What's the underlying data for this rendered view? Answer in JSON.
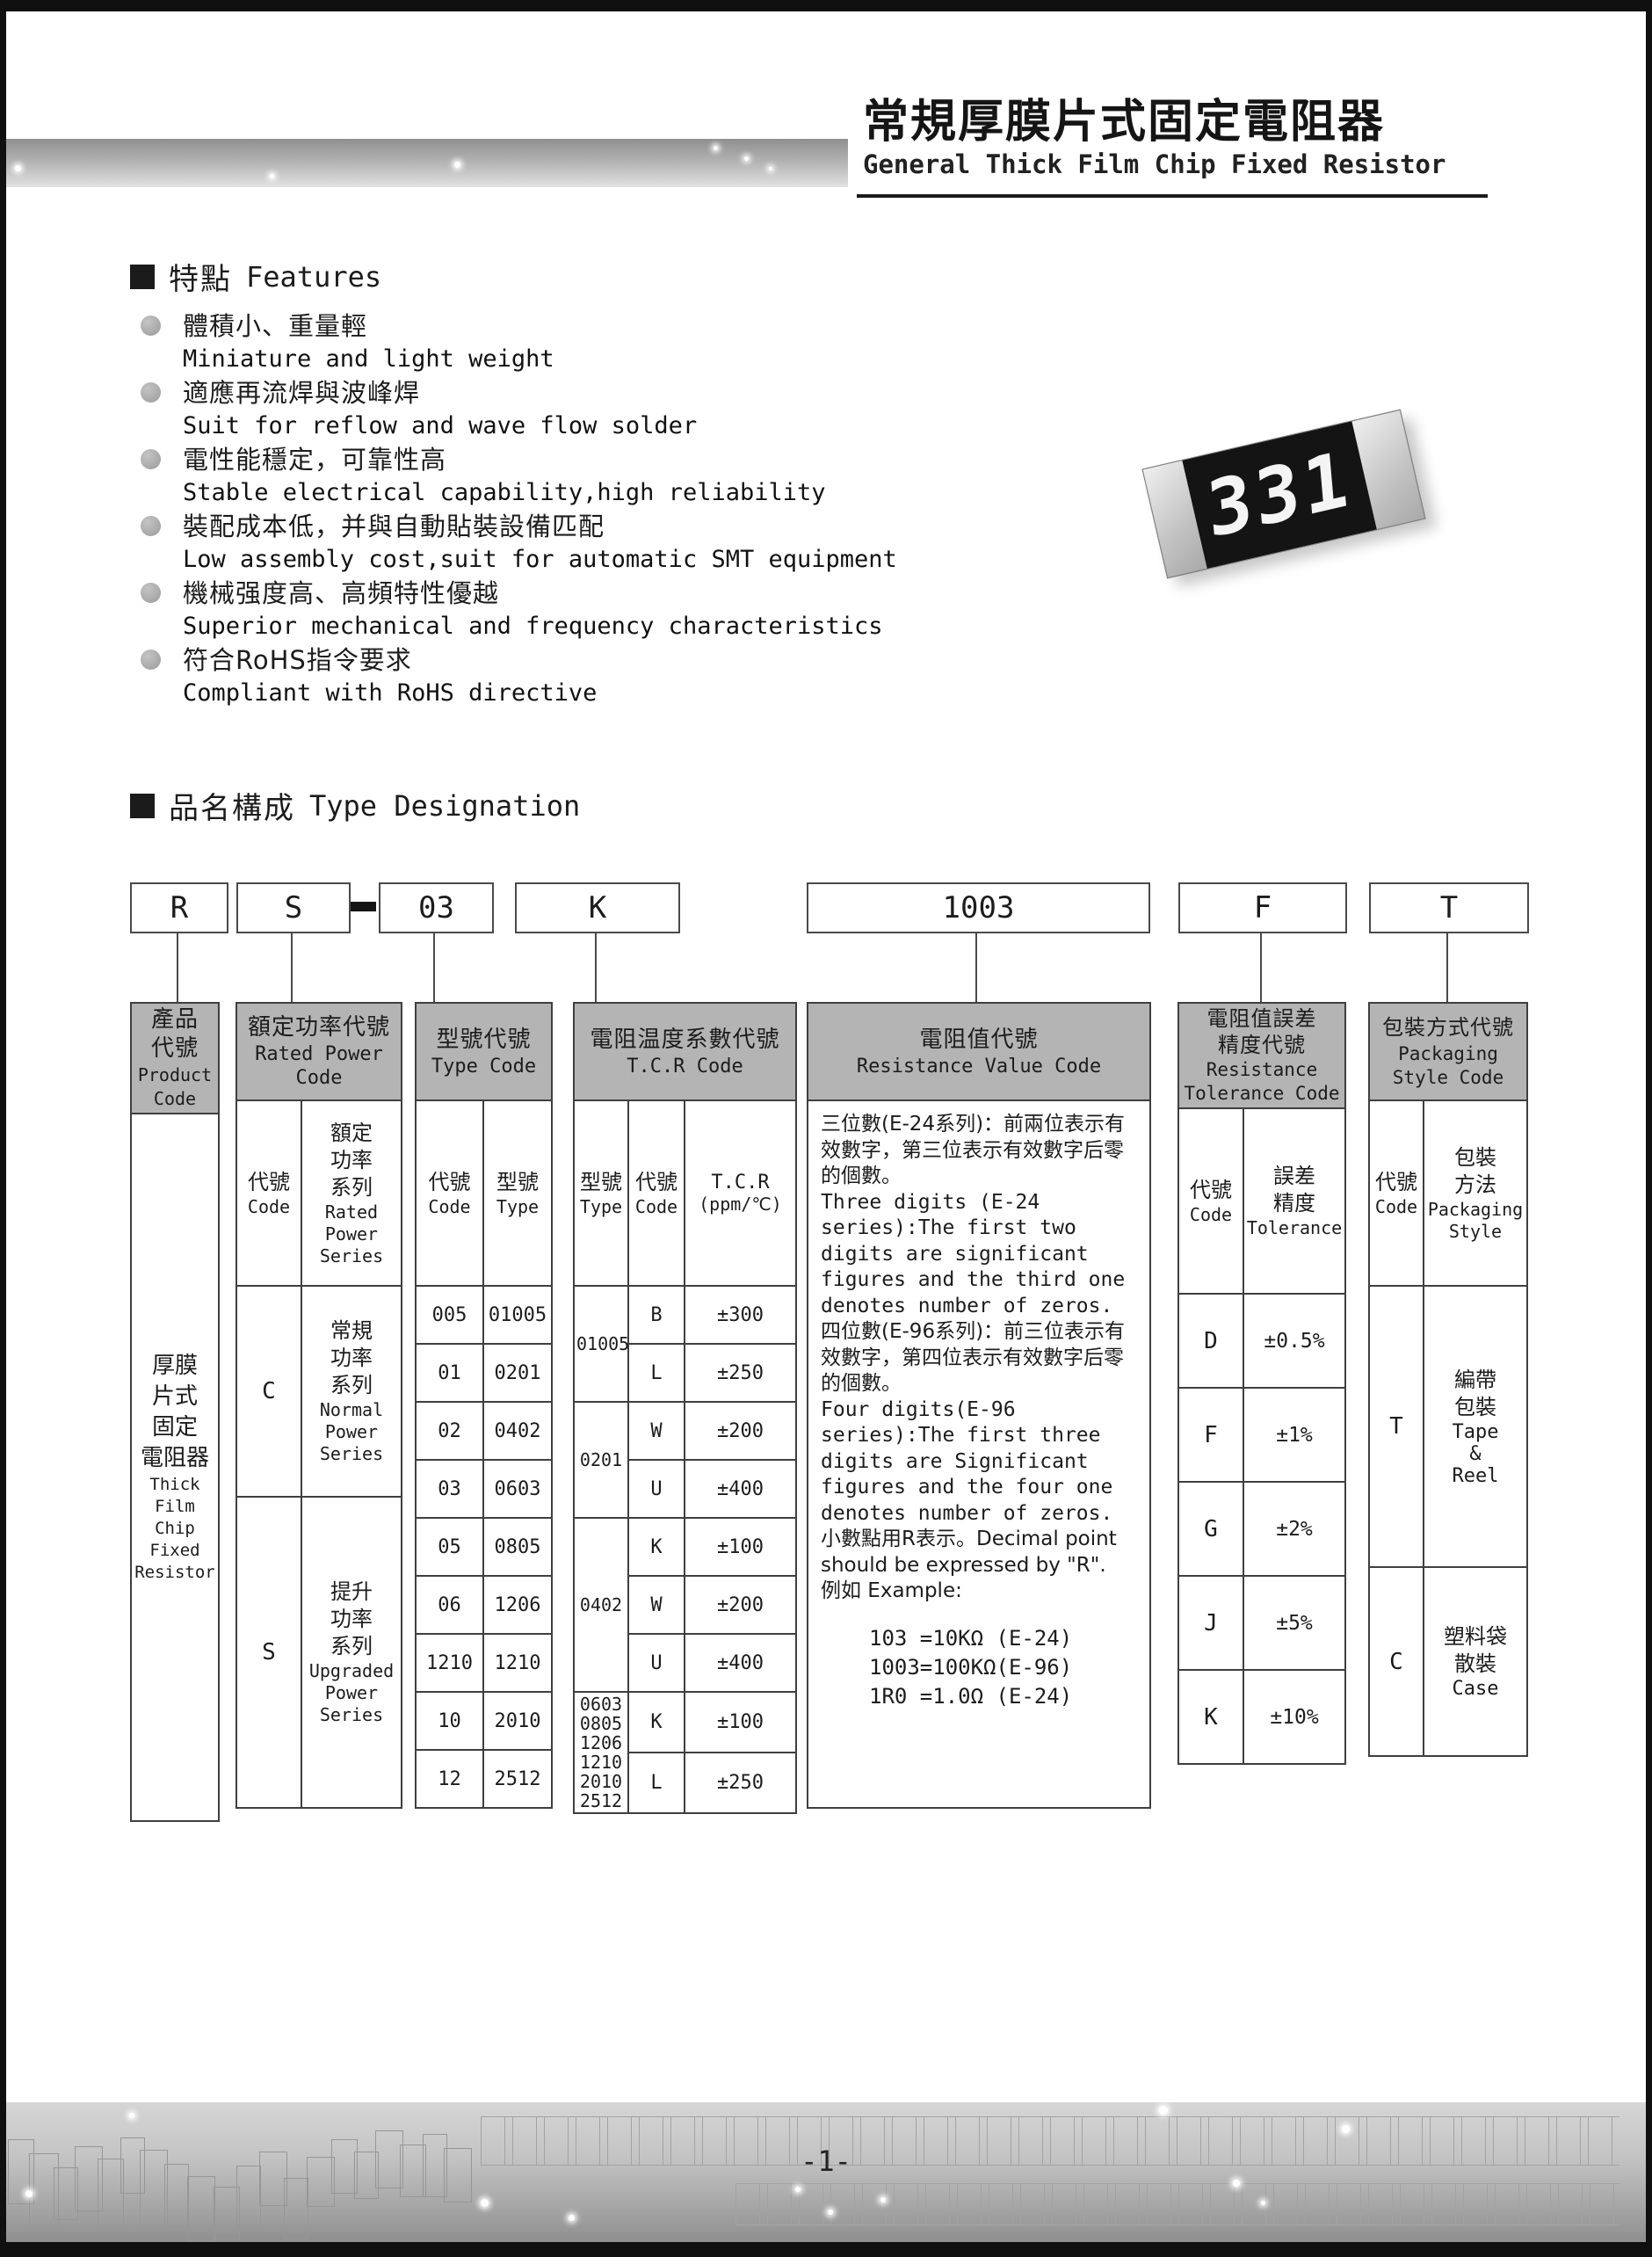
{
  "header": {
    "title_zh": "常規厚膜片式固定電阻器",
    "title_en": "General Thick Film Chip Fixed Resistor"
  },
  "features": {
    "heading_zh": "特點",
    "heading_en": "Features",
    "items": [
      {
        "zh": "體積小、重量輕",
        "en": "Miniature and light weight"
      },
      {
        "zh": "適應再流焊與波峰焊",
        "en": "Suit for reflow and wave flow solder"
      },
      {
        "zh": "電性能穩定，可靠性高",
        "en": "Stable electrical capability,high reliability"
      },
      {
        "zh": "裝配成本低，并與自動貼裝設備匹配",
        "en": "Low assembly cost,suit for automatic SMT equipment"
      },
      {
        "zh": "機械强度高、高頻特性優越",
        "en": "Superior mechanical and frequency characteristics"
      },
      {
        "zh": "符合RoHS指令要求",
        "en": "Compliant with RoHS directive"
      }
    ]
  },
  "resistor": {
    "marking": "331"
  },
  "designation": {
    "heading_zh": "品名構成",
    "heading_en": "Type Designation",
    "separator": "-",
    "boxes": [
      "R",
      "S",
      "03",
      "K",
      "1003",
      "F",
      "T"
    ]
  },
  "table": {
    "product": {
      "header_zh": "產品\n代號",
      "header_en": "Product\nCode",
      "body_zh": "厚膜\n片式\n固定\n電阻器",
      "body_en": "Thick\nFilm\nChip\nFixed\nResistor"
    },
    "rated_power": {
      "header_zh": "額定功率代號",
      "header_en": "Rated Power\nCode",
      "code_label_zh": "代號",
      "code_label_en": "Code",
      "series_label_zh": "額定\n功率\n系列",
      "series_label_en": "Rated\nPower\nSeries",
      "rows": [
        {
          "code": "C",
          "series_zh": "常規\n功率\n系列",
          "series_en": "Normal\nPower\nSeries"
        },
        {
          "code": "S",
          "series_zh": "提升\n功率\n系列",
          "series_en": "Upgraded\nPower\nSeries"
        }
      ]
    },
    "type_code": {
      "header_zh": "型號代號",
      "header_en": "Type Code",
      "code_label_zh": "代號",
      "code_label_en": "Code",
      "type_label_zh": "型號",
      "type_label_en": "Type",
      "rows": [
        {
          "code": "005",
          "type": "01005"
        },
        {
          "code": "01",
          "type": "0201"
        },
        {
          "code": "02",
          "type": "0402"
        },
        {
          "code": "03",
          "type": "0603"
        },
        {
          "code": "05",
          "type": "0805"
        },
        {
          "code": "06",
          "type": "1206"
        },
        {
          "code": "1210",
          "type": "1210"
        },
        {
          "code": "10",
          "type": "2010"
        },
        {
          "code": "12",
          "type": "2512"
        }
      ]
    },
    "tcr": {
      "header_zh": "電阻温度系數代號",
      "header_en": "T.C.R Code",
      "type_label_zh": "型號",
      "type_label_en": "Type",
      "code_label_zh": "代號",
      "code_label_en": "Code",
      "tcr_label": "T.C.R",
      "tcr_unit": "(ppm/℃)",
      "groups": [
        {
          "type": "01005",
          "entries": [
            {
              "code": "B",
              "value": "±300"
            },
            {
              "code": "L",
              "value": "±250"
            }
          ]
        },
        {
          "type": "0201",
          "entries": [
            {
              "code": "W",
              "value": "±200"
            },
            {
              "code": "U",
              "value": "±400"
            }
          ]
        },
        {
          "type": "0402",
          "entries": [
            {
              "code": "K",
              "value": "±100"
            },
            {
              "code": "W",
              "value": "±200"
            },
            {
              "code": "U",
              "value": "±400"
            }
          ]
        },
        {
          "type": "0603\n0805\n1206\n1210\n2010\n2512",
          "entries": [
            {
              "code": "K",
              "value": "±100"
            },
            {
              "code": "L",
              "value": "±250"
            }
          ]
        }
      ]
    },
    "resistance_value": {
      "header_zh": "電阻值代號",
      "header_en": "Resistance Value Code",
      "paragraphs": [
        "三位數(E-24系列)：前兩位表示有效數字，第三位表示有效數字后零的個數。",
        "Three digits (E-24 series):The first two digits are significant figures and the third one denotes number of zeros.",
        "四位數(E-96系列)：前三位表示有效數字，第四位表示有效數字后零的個數。",
        "Four digits(E-96 series):The first three digits are Significant figures and the four one denotes number of zeros.",
        "小數點用R表示。Decimal point should be expressed by \"R\".",
        "例如 Example:"
      ],
      "examples": [
        "103 =10KΩ (E-24)",
        "1003=100KΩ(E-96)",
        "1R0 =1.0Ω (E-24)"
      ]
    },
    "tolerance": {
      "header_zh": "電阻值誤差\n精度代號",
      "header_en": "Resistance\nTolerance Code",
      "code_label_zh": "代號",
      "code_label_en": "Code",
      "tol_label_zh": "誤差\n精度",
      "tol_label_en": "Tolerance",
      "rows": [
        {
          "code": "D",
          "value": "±0.5%"
        },
        {
          "code": "F",
          "value": "±1%"
        },
        {
          "code": "G",
          "value": "±2%"
        },
        {
          "code": "J",
          "value": "±5%"
        },
        {
          "code": "K",
          "value": "±10%"
        }
      ]
    },
    "packaging": {
      "header_zh": "包裝方式代號",
      "header_en": "Packaging\nStyle Code",
      "code_label_zh": "代號",
      "code_label_en": "Code",
      "style_label_zh": "包裝\n方法",
      "style_label_en": "Packaging\nStyle",
      "rows": [
        {
          "code": "T",
          "style_zh": "編帶\n包裝",
          "style_en": "Tape\n&\nReel"
        },
        {
          "code": "C",
          "style_zh": "塑料袋\n散裝",
          "style_en": "Case"
        }
      ]
    }
  },
  "footer": {
    "page_number": "-1-"
  }
}
